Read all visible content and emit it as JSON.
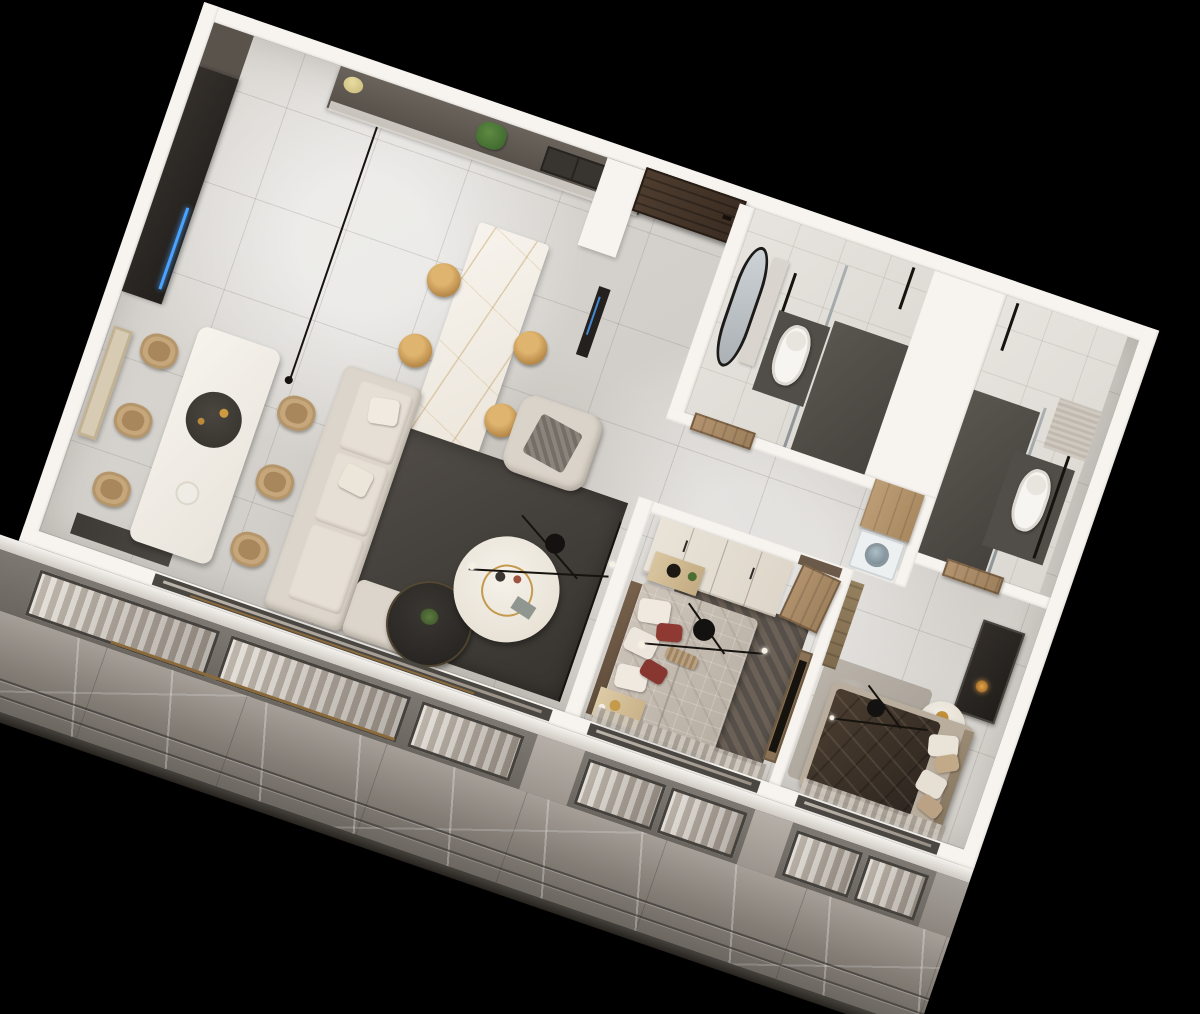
{
  "scene": {
    "type": "isometric-3d-floorplan-render",
    "background": "#000000",
    "rotation_deg": 19,
    "palette": {
      "wall_white": "#f7f4f0",
      "floor_marble_light": "#d6d3ce",
      "facade_marble_gray": "#837d76",
      "rug_charcoal": "#47433e",
      "sofa_beige": "#dcd5cb",
      "wood_door_dark": "#4a3a2d",
      "wood_door_light": "#b4946f",
      "island_gold_vein": "#ba914c",
      "stool_brass": "#b88a4a",
      "accent_pillow_red": "#8e3a32",
      "bed2_duvet_brown": "#3a3027",
      "shower_tile_dark": "#55514c",
      "window_frame": "#45413c",
      "led_blue": "#4aa3ff"
    },
    "apartment": {
      "rooms": [
        {
          "name": "kitchen",
          "furniture": [
            "kitchen-counter",
            "sink",
            "tall-dark-cabinet",
            "marble-island",
            "bar-stool",
            "bar-stool",
            "bar-stool",
            "bar-stool",
            "pendant-light-line",
            "plant",
            "teapot"
          ]
        },
        {
          "name": "dining-area",
          "furniture": [
            "dining-table",
            "dining-chair",
            "dining-chair",
            "dining-chair",
            "dining-chair",
            "dining-chair",
            "dining-chair",
            "centerpiece",
            "wall-art",
            "doormat"
          ]
        },
        {
          "name": "living-room",
          "furniture": [
            "sectional-sofa",
            "chaise",
            "armchair",
            "charcoal-rug",
            "round-coffee-table",
            "dark-side-table",
            "sputnik-chandelier",
            "track-light-line",
            "track-light-line"
          ]
        },
        {
          "name": "entry",
          "furniture": [
            "entry-door",
            "closet-pier",
            "appliance-panel"
          ]
        },
        {
          "name": "bathroom-1",
          "furniture": [
            "toilet",
            "shower-area",
            "glass-screen",
            "oval-mirror",
            "vanity",
            "towel-rail",
            "door"
          ]
        },
        {
          "name": "bathroom-2",
          "furniture": [
            "toilet",
            "shower-area",
            "glass-screen",
            "towel-rail",
            "niche",
            "door"
          ]
        },
        {
          "name": "laundry-nook",
          "furniture": [
            "wood-cabinet",
            "washing-machine"
          ]
        },
        {
          "name": "bedroom-1",
          "furniture": [
            "plaid-bed",
            "headboard",
            "wardrobe",
            "nightstand",
            "nightstand",
            "patterned-rug",
            "tv-panel",
            "sputnik-chandelier",
            "open-door",
            "curtain"
          ]
        },
        {
          "name": "master-bedroom",
          "furniture": [
            "dark-bed",
            "headboard",
            "vanity-desk",
            "round-side-table",
            "closet-strip",
            "shag-rug",
            "sputnik-chandelier",
            "curtain"
          ]
        },
        {
          "name": "balcony-facade",
          "furniture": [
            "floor-slab-edge",
            "window-wall",
            "sliding-door-track",
            "marble-cladding",
            "base-lip"
          ]
        }
      ]
    }
  }
}
